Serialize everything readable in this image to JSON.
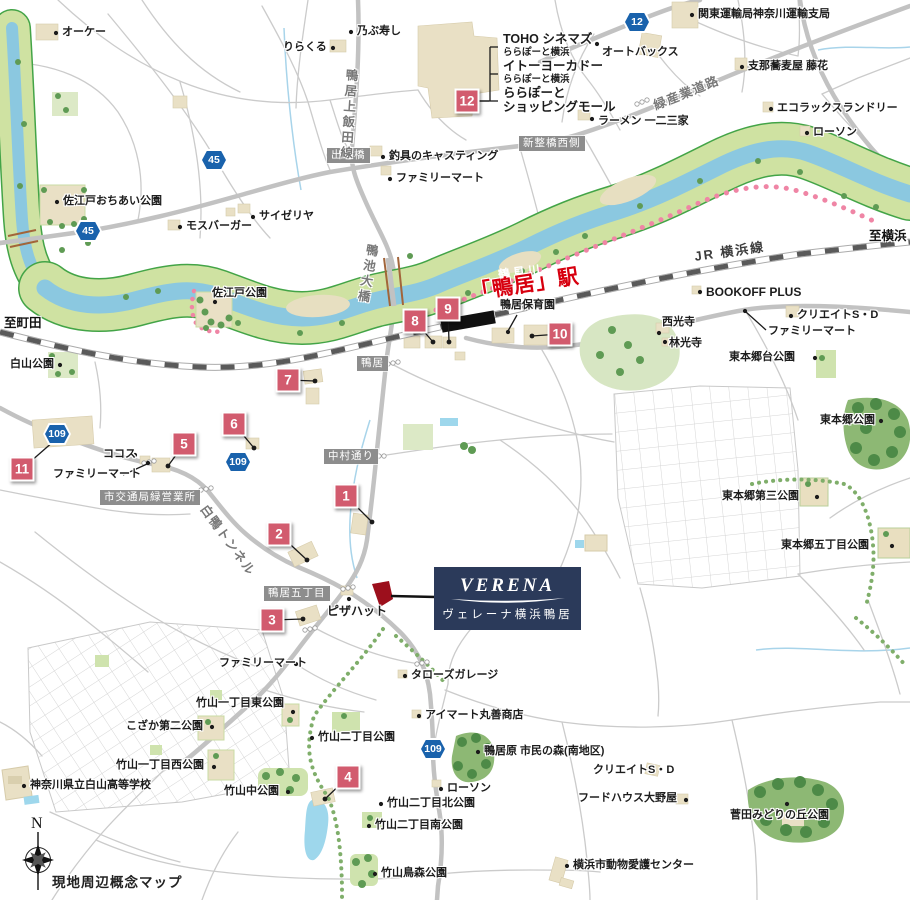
{
  "map": {
    "note": "現地周辺概念マップ",
    "compass": {
      "north": "N"
    },
    "project": {
      "logo": "VERENA",
      "name": "ヴェレーナ横浜鴨居"
    },
    "station": {
      "name": "「鴨居」駅"
    },
    "rail_line": {
      "text": "JR 横浜線"
    },
    "river": {
      "text": "鶴見川"
    },
    "direction_labels": [
      {
        "text": "至町田",
        "x": 4,
        "y": 312
      },
      {
        "text": "至横浜",
        "x": 869,
        "y": 225
      }
    ],
    "road_labels": [
      {
        "text": "緑産業道路",
        "x": 650,
        "y": 96,
        "rot": -22
      },
      {
        "text": "鴨居上飯田線",
        "x": 342,
        "y": 68,
        "rot": 4,
        "vertical": true
      },
      {
        "text": "鴨池大橋",
        "x": 363,
        "y": 242,
        "rot": 10,
        "vertical": true
      },
      {
        "text": "白鴨トンネル",
        "x": 212,
        "y": 500,
        "rot": 54
      }
    ],
    "area_boxes": [
      {
        "text": "出崎橋",
        "x": 327,
        "y": 148
      },
      {
        "text": "新整橋西側",
        "x": 519,
        "y": 136
      },
      {
        "text": "鴨居",
        "x": 357,
        "y": 356
      },
      {
        "text": "中村通り",
        "x": 324,
        "y": 449
      },
      {
        "text": "市交通局緑営業所",
        "x": 100,
        "y": 490
      },
      {
        "text": "鴨居五丁目",
        "x": 264,
        "y": 586
      }
    ],
    "route_shields": [
      {
        "num": "45",
        "x": 214,
        "y": 160
      },
      {
        "num": "45",
        "x": 88,
        "y": 231
      },
      {
        "num": "12",
        "x": 637,
        "y": 22
      },
      {
        "num": "109",
        "x": 57,
        "y": 434
      },
      {
        "num": "109",
        "x": 238,
        "y": 462
      },
      {
        "num": "109",
        "x": 433,
        "y": 749
      }
    ],
    "markers": [
      {
        "num": "1",
        "x": 346,
        "y": 496,
        "tx": 372,
        "ty": 522
      },
      {
        "num": "2",
        "x": 279,
        "y": 534,
        "tx": 307,
        "ty": 560
      },
      {
        "num": "3",
        "x": 272,
        "y": 620,
        "tx": 303,
        "ty": 619
      },
      {
        "num": "4",
        "x": 348,
        "y": 777,
        "tx": 325,
        "ty": 799
      },
      {
        "num": "5",
        "x": 184,
        "y": 444,
        "tx": 168,
        "ty": 466
      },
      {
        "num": "6",
        "x": 234,
        "y": 424,
        "tx": 254,
        "ty": 448
      },
      {
        "num": "7",
        "x": 288,
        "y": 380,
        "tx": 315,
        "ty": 381
      },
      {
        "num": "8",
        "x": 415,
        "y": 321,
        "tx": 433,
        "ty": 342
      },
      {
        "num": "9",
        "x": 448,
        "y": 309,
        "tx": 449,
        "ty": 342
      },
      {
        "num": "10",
        "x": 560,
        "y": 334,
        "tx": 532,
        "ty": 336
      },
      {
        "num": "11",
        "x": 22,
        "y": 469,
        "tx": 62,
        "ty": 434
      },
      {
        "num": "12",
        "x": 467,
        "y": 101,
        "tx": 489,
        "ty": 101,
        "nd": 1
      }
    ],
    "pois": [
      {
        "t": "オーケー",
        "x": 62,
        "y": 27,
        "dot": [
          56,
          33
        ]
      },
      {
        "t": "乃ぶ寿し",
        "x": 357,
        "y": 26,
        "dot": [
          351,
          32
        ]
      },
      {
        "t": "りらくる",
        "x": 283,
        "y": 42,
        "dot": [
          333,
          48
        ]
      },
      {
        "t": "TOHO シネマズ",
        "x": 503,
        "y": 33,
        "s": 12.5
      },
      {
        "t": "ららぽーと横浜",
        "x": 503,
        "y": 48,
        "s": 9.5
      },
      {
        "t": "イトーヨーカドー",
        "x": 503,
        "y": 60,
        "s": 12.5
      },
      {
        "t": "ららぽーと横浜",
        "x": 503,
        "y": 75,
        "s": 9.5
      },
      {
        "t": "ららぽーと",
        "x": 503,
        "y": 87,
        "s": 12.5
      },
      {
        "t": "ショッピングモール",
        "x": 503,
        "y": 101,
        "s": 12.5
      },
      {
        "t": "オートバックス",
        "x": 602,
        "y": 47,
        "dot": [
          597,
          44
        ]
      },
      {
        "t": "関東運輸局神奈川運輸支局",
        "x": 698,
        "y": 9,
        "dot": [
          692,
          15
        ]
      },
      {
        "t": "支那蕎麦屋 藤花",
        "x": 748,
        "y": 61,
        "dot": [
          742,
          67
        ]
      },
      {
        "t": "エコラックスランドリー",
        "x": 777,
        "y": 103,
        "dot": [
          771,
          109
        ]
      },
      {
        "t": "ローソン",
        "x": 813,
        "y": 127,
        "dot": [
          807,
          133
        ]
      },
      {
        "t": "ラーメン 一二三家",
        "x": 598,
        "y": 116,
        "dot": [
          592,
          119
        ]
      },
      {
        "t": "釣具のキャスティング",
        "x": 389,
        "y": 151,
        "dot": [
          383,
          157
        ]
      },
      {
        "t": "ファミリーマート",
        "x": 396,
        "y": 173,
        "dot": [
          390,
          179
        ]
      },
      {
        "t": "モスバーガー",
        "x": 186,
        "y": 221,
        "dot": [
          180,
          227
        ]
      },
      {
        "t": "サイゼリヤ",
        "x": 259,
        "y": 211,
        "dot": [
          253,
          217
        ]
      },
      {
        "t": "佐江戸おちあい公園",
        "x": 63,
        "y": 196,
        "dot": [
          57,
          202
        ]
      },
      {
        "t": "佐江戸公園",
        "x": 212,
        "y": 288,
        "dot": [
          215,
          302
        ]
      },
      {
        "t": "白山公園",
        "x": 10,
        "y": 359,
        "dot": [
          60,
          365
        ]
      },
      {
        "t": "鴨居保育園",
        "x": 500,
        "y": 300,
        "line": [
          517,
          315,
          508,
          331
        ],
        "dot": [
          508,
          332
        ]
      },
      {
        "t": "BOOKOFF PLUS",
        "x": 706,
        "y": 286,
        "s": 12,
        "dot": [
          700,
          292
        ]
      },
      {
        "t": "クリエイトS・D",
        "x": 797,
        "y": 310,
        "dot": [
          791,
          316
        ]
      },
      {
        "t": "ファミリーマート",
        "x": 768,
        "y": 326,
        "line": [
          766,
          330,
          746,
          312
        ],
        "dot": [
          745,
          311
        ]
      },
      {
        "t": "西光寺",
        "x": 662,
        "y": 317,
        "dot": [
          659,
          333
        ]
      },
      {
        "t": "林光寺",
        "x": 669,
        "y": 338,
        "dot": [
          665,
          342
        ]
      },
      {
        "t": "東本郷台公園",
        "x": 729,
        "y": 352,
        "dot": [
          815,
          358
        ]
      },
      {
        "t": "東本郷公園",
        "x": 820,
        "y": 415,
        "dot": [
          881,
          421
        ]
      },
      {
        "t": "東本郷第三公園",
        "x": 722,
        "y": 491,
        "dot": [
          817,
          497
        ]
      },
      {
        "t": "東本郷五丁目公園",
        "x": 781,
        "y": 540,
        "dot": [
          892,
          546
        ]
      },
      {
        "t": "ココス",
        "x": 103,
        "y": 449,
        "dot": [
          135,
          455
        ]
      },
      {
        "t": "ファミリーマート",
        "x": 53,
        "y": 469,
        "line": [
          123,
          475,
          147,
          464
        ],
        "dot": [
          148,
          463
        ]
      },
      {
        "t": "ピザハット",
        "x": 327,
        "y": 605,
        "s": 12,
        "dot": [
          349,
          599
        ]
      },
      {
        "t": "ファミリーマート",
        "x": 219,
        "y": 658,
        "dot": [
          296,
          664
        ]
      },
      {
        "t": "タローズガレージ",
        "x": 411,
        "y": 670,
        "dot": [
          405,
          676
        ]
      },
      {
        "t": "竹山一丁目東公園",
        "x": 196,
        "y": 698,
        "dot": [
          293,
          712
        ]
      },
      {
        "t": "こざか第二公園",
        "x": 126,
        "y": 721,
        "dot": [
          212,
          727
        ]
      },
      {
        "t": "アイマート丸善商店",
        "x": 425,
        "y": 710,
        "dot": [
          419,
          716
        ]
      },
      {
        "t": "竹山二丁目公園",
        "x": 318,
        "y": 732,
        "dot": [
          312,
          738
        ]
      },
      {
        "t": "竹山一丁目西公園",
        "x": 116,
        "y": 760,
        "dot": [
          214,
          767
        ]
      },
      {
        "t": "神奈川県立白山高等学校",
        "x": 30,
        "y": 780,
        "dot": [
          24,
          786
        ]
      },
      {
        "t": "竹山中公園",
        "x": 224,
        "y": 786,
        "dot": [
          288,
          792
        ]
      },
      {
        "t": "鴨居原 市民の森(南地区)",
        "x": 484,
        "y": 746,
        "dot": [
          478,
          752
        ]
      },
      {
        "t": "クリエイトS・D",
        "x": 593,
        "y": 765,
        "dot": [
          653,
          772
        ]
      },
      {
        "t": "ローソン",
        "x": 447,
        "y": 783,
        "dot": [
          441,
          789
        ]
      },
      {
        "t": "竹山二丁目北公園",
        "x": 387,
        "y": 798,
        "dot": [
          381,
          804
        ]
      },
      {
        "t": "竹山二丁目南公園",
        "x": 375,
        "y": 820,
        "dot": [
          369,
          826
        ]
      },
      {
        "t": "フードハウス大野屋",
        "x": 578,
        "y": 793,
        "dot": [
          686,
          800
        ]
      },
      {
        "t": "菅田みどりの丘公園",
        "x": 730,
        "y": 810,
        "dot": [
          787,
          804
        ]
      },
      {
        "t": "横浜市動物愛護センター",
        "x": 573,
        "y": 860,
        "dot": [
          567,
          866
        ]
      },
      {
        "t": "竹山鳥森公園",
        "x": 381,
        "y": 868,
        "dot": [
          375,
          874
        ]
      }
    ],
    "colors": {
      "marker_pink": "#d25b6e",
      "shield_blue": "#1962ac",
      "station_red": "#d7000f",
      "site_red": "#9c0f1c",
      "brand_navy": "#2b3a5a",
      "river_blue": "#8bc8e0",
      "bank_green": "#cfe2a2"
    }
  }
}
